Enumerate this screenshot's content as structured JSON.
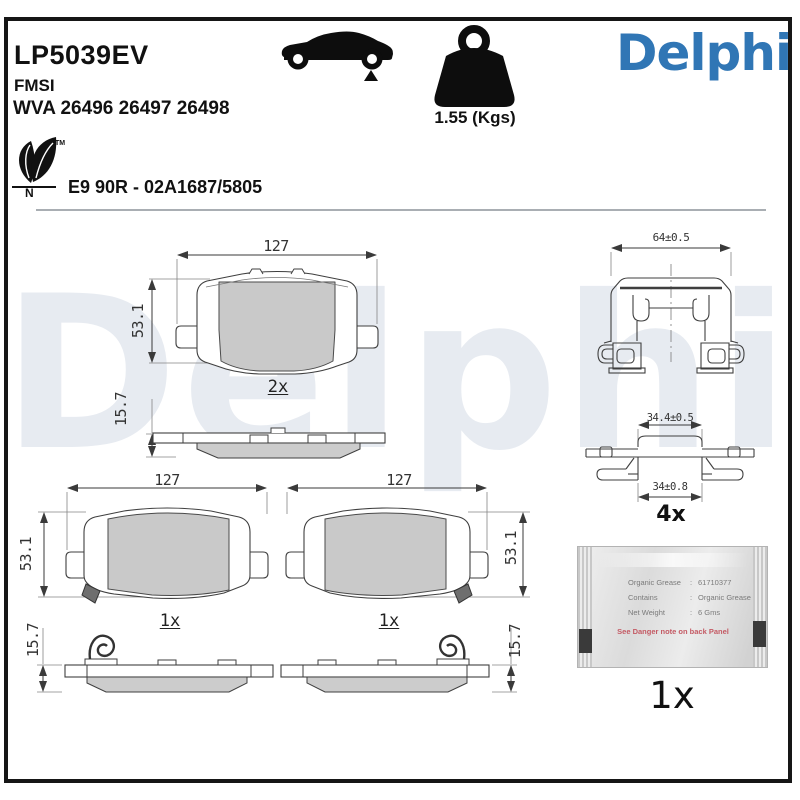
{
  "header": {
    "part_number": "LP5039EV",
    "fmsi": "FMSI",
    "wva": "WVA 26496 26497 26498",
    "homologation": "E9 90R - 02A1687/5805",
    "weight_label": "1.55 (Kgs)",
    "brand": "Delphi",
    "brand_color": "#3076B5",
    "eco_tm": "TM",
    "eco_letter": "N"
  },
  "watermark_text": "Delphi",
  "drawings": {
    "pad_back_view": {
      "width": "127",
      "height": "53.1",
      "qty": "2x"
    },
    "pad_side_view_top": {
      "thickness": "15.7"
    },
    "pad_front_left": {
      "width": "127",
      "height": "53.1",
      "qty": "1x"
    },
    "pad_front_right": {
      "width": "127",
      "height": "53.1",
      "qty": "1x"
    },
    "pad_side_bottom_left": {
      "thickness": "15.7"
    },
    "pad_side_bottom_right": {
      "thickness": "15.7"
    },
    "fitting_clip_front": {
      "width": "64±0.5"
    },
    "fitting_clip_side": {
      "width_top": "34.4±0.5",
      "width_bottom": "34±0.8",
      "qty": "4x"
    },
    "grease_sachet": {
      "rows": [
        {
          "label": "Organic Grease",
          "colon": ":",
          "value": "61710377"
        },
        {
          "label": "Contains",
          "colon": ":",
          "value": "Organic Grease"
        },
        {
          "label": "Net Weight",
          "colon": ":",
          "value": "6 Gms"
        }
      ],
      "warning": "See Danger note on back Panel",
      "qty": "1x"
    }
  }
}
